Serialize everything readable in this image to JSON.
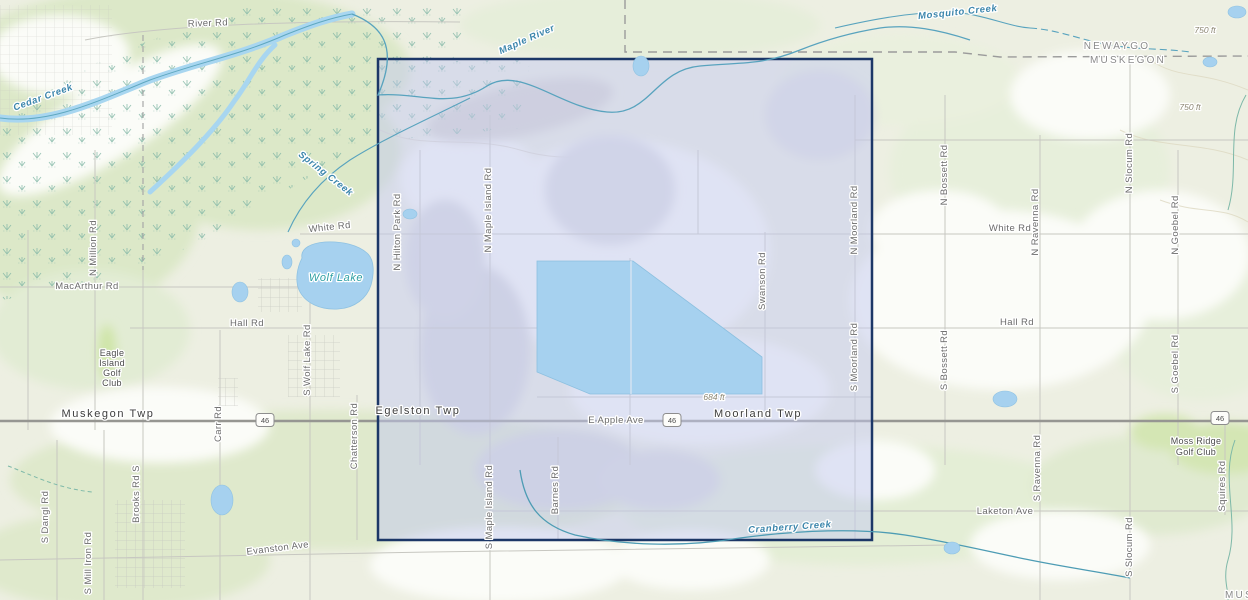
{
  "colors": {
    "background": "#edefe2",
    "selection_fill": "rgba(196,201,240,0.5)",
    "selection_border": "#1c3767",
    "lake_fill": "#a6d1ef",
    "creek": "#58a3be"
  },
  "selection": {
    "x": 378,
    "y": 59,
    "width": 494,
    "height": 481
  },
  "shields": [
    {
      "label": "46",
      "x": 265,
      "y": 420
    },
    {
      "label": "46",
      "x": 672,
      "y": 420
    },
    {
      "label": "46",
      "x": 1220,
      "y": 418
    }
  ],
  "labels": [
    {
      "text": "River Rd",
      "x": 208,
      "y": 26,
      "rot": -2,
      "type": "road"
    },
    {
      "text": "White Rd",
      "x": 330,
      "y": 230,
      "rot": -6,
      "type": "road"
    },
    {
      "text": "MacArthur Rd",
      "x": 87,
      "y": 289,
      "type": "road"
    },
    {
      "text": "Hall Rd",
      "x": 247,
      "y": 326,
      "type": "road"
    },
    {
      "text": "E Apple Ave",
      "x": 616,
      "y": 423,
      "type": "road"
    },
    {
      "text": "White Rd",
      "x": 1010,
      "y": 231,
      "type": "road"
    },
    {
      "text": "Hall Rd",
      "x": 1017,
      "y": 325,
      "type": "road"
    },
    {
      "text": "Laketon Ave",
      "x": 1005,
      "y": 514,
      "type": "road"
    },
    {
      "text": "Evanston Ave",
      "x": 278,
      "y": 551,
      "rot": -7,
      "type": "road"
    },
    {
      "text": "Muskegon Twp",
      "x": 108,
      "y": 417,
      "type": "township"
    },
    {
      "text": "Egelston Twp",
      "x": 418,
      "y": 414,
      "type": "township"
    },
    {
      "text": "Moorland Twp",
      "x": 758,
      "y": 417,
      "type": "township"
    },
    {
      "text": "N Million Rd",
      "x": 96,
      "y": 248,
      "rot": -90,
      "type": "road"
    },
    {
      "text": "S Wolf Lake Rd",
      "x": 310,
      "y": 360,
      "rot": -90,
      "type": "road"
    },
    {
      "text": "Carr Rd",
      "x": 221,
      "y": 424,
      "rot": -90,
      "type": "road"
    },
    {
      "text": "Chatterson Rd",
      "x": 357,
      "y": 436,
      "rot": -90,
      "type": "road"
    },
    {
      "text": "S Dangl Rd",
      "x": 48,
      "y": 517,
      "rot": -90,
      "type": "road"
    },
    {
      "text": "S Mill Iron Rd",
      "x": 91,
      "y": 563,
      "rot": -90,
      "type": "road"
    },
    {
      "text": "Brooks Rd S",
      "x": 139,
      "y": 494,
      "rot": -90,
      "type": "road"
    },
    {
      "text": "N Hilton Park Rd",
      "x": 400,
      "y": 232,
      "rot": -90,
      "type": "road"
    },
    {
      "text": "N Maple Island Rd",
      "x": 491,
      "y": 210,
      "rot": -90,
      "type": "road"
    },
    {
      "text": "S Maple Island Rd",
      "x": 492,
      "y": 507,
      "rot": -90,
      "type": "road"
    },
    {
      "text": "Barnes Rd",
      "x": 558,
      "y": 490,
      "rot": -90,
      "type": "road"
    },
    {
      "text": "Swanson Rd",
      "x": 765,
      "y": 281,
      "rot": -90,
      "type": "road"
    },
    {
      "text": "N Moorland Rd",
      "x": 857,
      "y": 220,
      "rot": -90,
      "type": "road"
    },
    {
      "text": "S Moorland Rd",
      "x": 857,
      "y": 357,
      "rot": -90,
      "type": "road"
    },
    {
      "text": "N Bossett Rd",
      "x": 947,
      "y": 175,
      "rot": -90,
      "type": "road"
    },
    {
      "text": "S Bossett Rd",
      "x": 947,
      "y": 360,
      "rot": -90,
      "type": "road"
    },
    {
      "text": "N Ravenna Rd",
      "x": 1038,
      "y": 222,
      "rot": -90,
      "type": "road"
    },
    {
      "text": "S Ravenna Rd",
      "x": 1040,
      "y": 468,
      "rot": -90,
      "type": "road"
    },
    {
      "text": "N Slocum Rd",
      "x": 1132,
      "y": 163,
      "rot": -90,
      "type": "road"
    },
    {
      "text": "S Slocum Rd",
      "x": 1132,
      "y": 547,
      "rot": -90,
      "type": "road"
    },
    {
      "text": "N Goebel Rd",
      "x": 1178,
      "y": 225,
      "rot": -90,
      "type": "road"
    },
    {
      "text": "S Goebel Rd",
      "x": 1178,
      "y": 364,
      "rot": -90,
      "type": "road"
    },
    {
      "text": "Squires Rd",
      "x": 1225,
      "y": 486,
      "rot": -90,
      "type": "road"
    },
    {
      "text": "Cedar Creek",
      "x": 44,
      "y": 100,
      "rot": -20,
      "type": "water"
    },
    {
      "text": "Spring Creek",
      "x": 324,
      "y": 176,
      "rot": 38,
      "type": "water"
    },
    {
      "text": "Maple River",
      "x": 528,
      "y": 42,
      "rot": -24,
      "type": "water"
    },
    {
      "text": "Mosquito Creek",
      "x": 958,
      "y": 15,
      "rot": -6,
      "type": "water"
    },
    {
      "text": "Cranberry Creek",
      "x": 790,
      "y": 530,
      "rot": -4,
      "type": "water"
    },
    {
      "text": "Wolf Lake",
      "x": 336,
      "y": 281,
      "type": "lake"
    },
    {
      "text": "NEWAYGO",
      "x": 1117,
      "y": 49,
      "type": "county"
    },
    {
      "text": "MUSKEGON",
      "x": 1128,
      "y": 63,
      "type": "county"
    },
    {
      "text": "MUSKEGON",
      "x": 1263,
      "y": 598,
      "type": "county"
    },
    {
      "text": "750 ft",
      "x": 1205,
      "y": 33,
      "type": "elevation"
    },
    {
      "text": "750 ft",
      "x": 1190,
      "y": 110,
      "type": "elevation"
    },
    {
      "text": "684 ft",
      "x": 714,
      "y": 400,
      "type": "elevation"
    },
    {
      "text": "Eagle",
      "x": 112,
      "y": 356,
      "type": "place"
    },
    {
      "text": "Island",
      "x": 112,
      "y": 366,
      "type": "place"
    },
    {
      "text": "Golf",
      "x": 112,
      "y": 376,
      "type": "place"
    },
    {
      "text": "Club",
      "x": 112,
      "y": 386,
      "type": "place"
    },
    {
      "text": "Moss Ridge",
      "x": 1196,
      "y": 444,
      "type": "place"
    },
    {
      "text": "Golf Club",
      "x": 1196,
      "y": 455,
      "type": "place"
    }
  ]
}
